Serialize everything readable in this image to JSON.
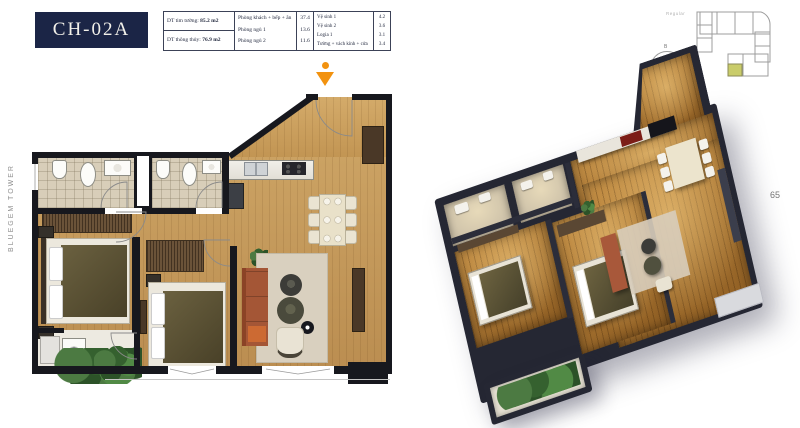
{
  "page": {
    "unit_code": "CH-02A",
    "tower_label": "BLUEGEM TOWER",
    "page_number": "65",
    "colors": {
      "navy": "#1b2546",
      "marker_orange": "#f2920f",
      "keyplan_highlight": "#c9cc6a",
      "wall_dark": "#17181e",
      "wood_floor": "#c49a5e"
    }
  },
  "info_table": {
    "area_rows": [
      {
        "label": "DT tim tường:",
        "value": "85.2 m2"
      },
      {
        "label": "DT thông thủy:",
        "value": "76.9 m2"
      }
    ],
    "rooms_main": [
      {
        "label": "Phòng khách + bếp + ăn",
        "value": "37.4"
      },
      {
        "label": "Phòng ngủ 1",
        "value": "13.6"
      },
      {
        "label": "Phòng ngủ 2",
        "value": "11.6"
      }
    ],
    "rooms_aux": [
      {
        "label": "Vệ sinh 1",
        "value": "4.2"
      },
      {
        "label": "Vệ sinh 2",
        "value": "3.6"
      },
      {
        "label": "Logia 1",
        "value": "3.1"
      },
      {
        "label": "Tường + vách kính + cửa",
        "value": "3.4"
      }
    ]
  },
  "key_plan": {
    "caption": "Regular",
    "north_label": "B"
  }
}
